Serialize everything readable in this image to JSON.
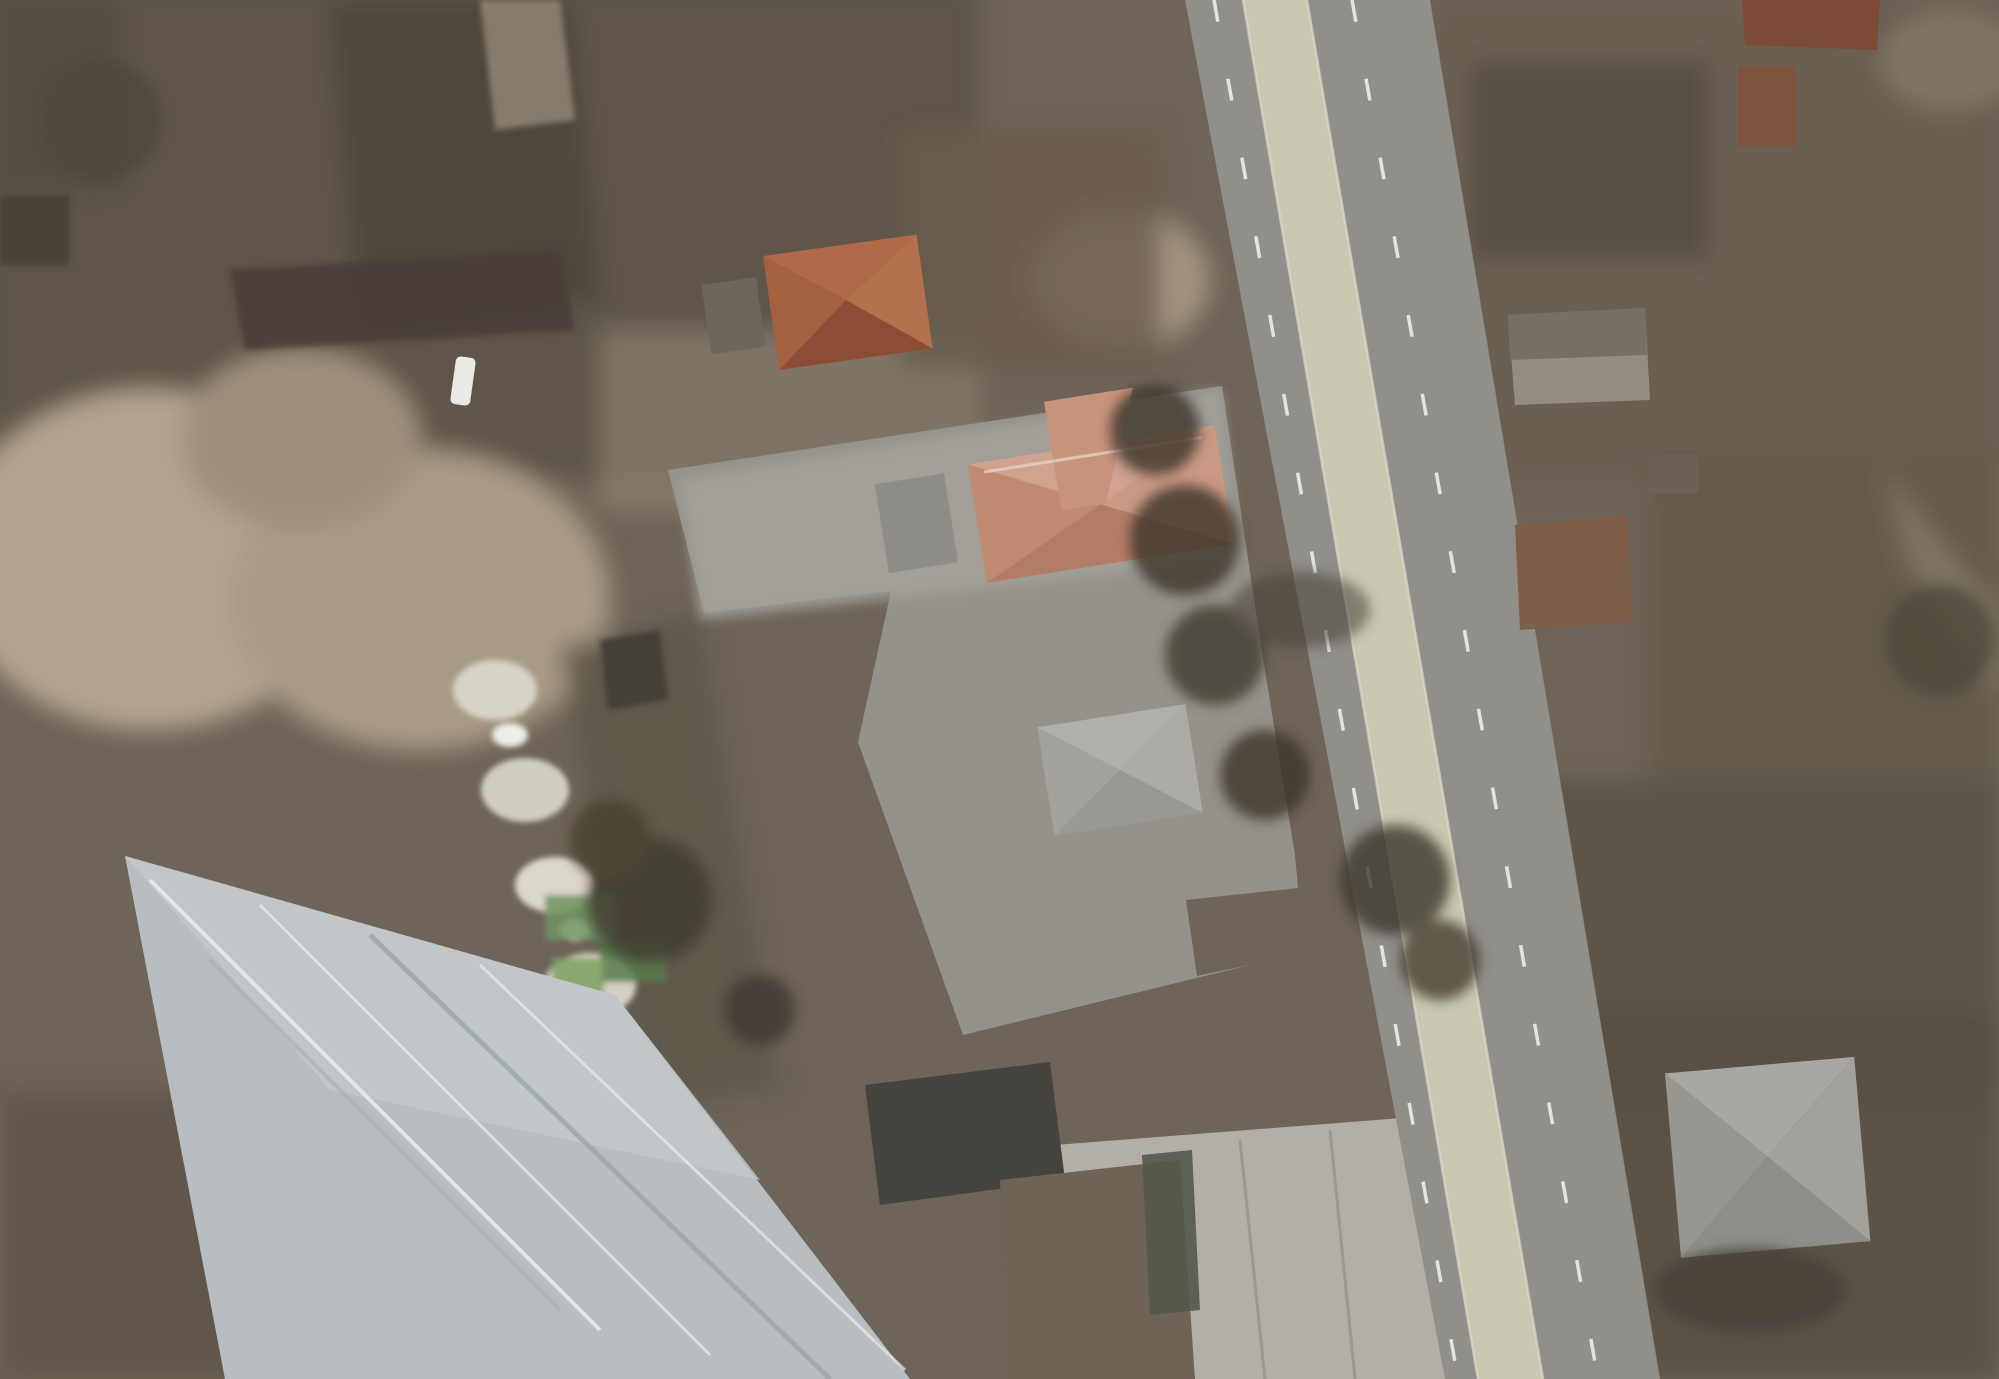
{
  "map": {
    "street_label": {
      "text": "str. Mihai Eminescu",
      "x": 1372,
      "y": 705,
      "rotation": 81,
      "size": 38
    },
    "survey_label": {
      "text": "6453210",
      "x": 883,
      "y": 692,
      "size": 30
    },
    "parcel_labels": [
      {
        "text": "161",
        "x": 158,
        "y": 139,
        "s": 46
      },
      {
        "text": "162",
        "x": 446,
        "y": 115,
        "s": 46
      },
      {
        "text": "216",
        "x": 684,
        "y": 30,
        "s": 40
      },
      {
        "text": "206",
        "x": 704,
        "y": 86,
        "s": 40
      },
      {
        "text": "1",
        "x": 733,
        "y": 125,
        "s": 30
      },
      {
        "text": "1",
        "x": 744,
        "y": 172,
        "s": 30
      },
      {
        "text": "203",
        "x": 742,
        "y": 205,
        "s": 40
      },
      {
        "text": "220",
        "x": 1006,
        "y": 254,
        "s": 44
      },
      {
        "text": "165",
        "x": 846,
        "y": 352,
        "s": 44
      },
      {
        "text": "8",
        "x": 157,
        "y": 318,
        "s": 38
      },
      {
        "text": "9",
        "x": 108,
        "y": 369,
        "s": 38
      },
      {
        "text": "59",
        "x": 20,
        "y": 537,
        "s": 46
      },
      {
        "text": "166",
        "x": 1042,
        "y": 667,
        "s": 48
      },
      {
        "text": "130",
        "x": 1550,
        "y": 92,
        "s": 44
      },
      {
        "text": "129",
        "x": 1855,
        "y": 100,
        "s": 44
      },
      {
        "text": "1",
        "x": 1772,
        "y": 12,
        "s": 30
      },
      {
        "text": "1",
        "x": 1541,
        "y": 375,
        "s": 30
      },
      {
        "text": "131",
        "x": 1690,
        "y": 435,
        "s": 44
      },
      {
        "text": "1",
        "x": 1543,
        "y": 589,
        "s": 28
      },
      {
        "text": "132",
        "x": 1707,
        "y": 650,
        "s": 44
      },
      {
        "text": "7",
        "x": 1402,
        "y": 748,
        "s": 34
      },
      {
        "text": "239",
        "x": 1729,
        "y": 965,
        "s": 44
      },
      {
        "text": "8",
        "x": 88,
        "y": 1052,
        "s": 36
      },
      {
        "text": "242",
        "x": 387,
        "y": 1072,
        "s": 44
      },
      {
        "text": "7",
        "x": 408,
        "y": 1165,
        "s": 36
      },
      {
        "text": "6",
        "x": 780,
        "y": 872,
        "s": 36
      },
      {
        "text": "3",
        "x": 880,
        "y": 1152,
        "s": 36
      },
      {
        "text": "244",
        "x": 1127,
        "y": 1232,
        "s": 44
      },
      {
        "text": "1",
        "x": 1053,
        "y": 1315,
        "s": 30
      },
      {
        "text": "1",
        "x": 1705,
        "y": 1157,
        "s": 32
      },
      {
        "text": "133",
        "x": 1763,
        "y": 1154,
        "s": 44
      },
      {
        "text": "2",
        "x": 1798,
        "y": 1176,
        "s": 32
      },
      {
        "text": "785",
        "x": 22,
        "y": 1372,
        "s": 36
      }
    ],
    "address_labels": [
      {
        "text": "15/B",
        "x": 1098,
        "y": 641,
        "s": 36
      },
      {
        "text": "10",
        "x": 1505,
        "y": 322,
        "s": 38
      },
      {
        "text": "8",
        "x": 1555,
        "y": 549,
        "s": 36
      },
      {
        "text": "6",
        "x": 1716,
        "y": 1119,
        "s": 40
      },
      {
        "text": "15/A",
        "x": 1049,
        "y": 1345,
        "s": 38
      }
    ],
    "dots": [
      [
        1152,
        662
      ],
      [
        1535,
        349
      ],
      [
        1576,
        573
      ],
      [
        1735,
        1143
      ],
      [
        1093,
        1368
      ]
    ],
    "dot_radius": 13,
    "hexagon": {
      "x": 1224,
      "y": 931,
      "r": 17
    },
    "arrow_points": "492,779 718,797 716,770 799,822 719,868 721,842 494,831",
    "cursor_points": "17,758 38,746 31,757 40,769 17,758",
    "colors": {
      "yellow": "#e8ea06",
      "green": "#31e23e",
      "teal": "#1cc474",
      "outline_green": "#1dc878",
      "red": "#d8301c",
      "red_fill": "rgba(205,35,20,0.38)",
      "red_fill_light": "rgba(205,35,20,0.12)",
      "orange": "#eda611",
      "dot": "#ffe61a",
      "dot_edge": "#20200e",
      "arrow": "#f6ee39"
    },
    "lines": {
      "yellow": [
        "315,0 323,60 343,203 325,227 330,250 305,262 306,343 317,460 340,600 352,690",
        "0,352 290,322 308,305 572,260 600,256",
        "28,450 48,350 95,290 150,270",
        "0,385 210,362 305,345",
        "0,412 190,388 252,378",
        "0,4 118,1",
        "545,0 568,160 595,352",
        "538,45 785,15 1000,0",
        "548,95 920,53 1143,8",
        "558,133 950,78 1148,42",
        "566,172 965,117 1150,80",
        "574,210 900,130",
        "900,130 1153,143",
        "620,300 900,315 1190,358",
        "595,352 640,385 668,470",
        "1133,0 1202,360 1228,390",
        "1300,885 1328,1043 1372,1220 1420,1379",
        "1375,0 1404,258 1450,542 1490,767 1563,1050 1627,1377",
        "1406,260 1983,339",
        "1705,0 1700,212 1697,300",
        "1457,450 1945,488",
        "1513,835 1922,805",
        "1999,295 1983,339 1951,462 1937,652 1918,803 1917,1003 1953,1290 1962,1379",
        "1545,1028 1917,1003",
        "1953,1290 1620,1327",
        "1620,1330 1850,1379",
        "937,1030 958,1037 963,1060 842,1077 830,1097 858,1212 888,1360 895,1379",
        "0,848 280,790 520,740 558,735",
        "0,750 350,690 558,645",
        "1310,947 1230,950 1190,1045",
        "648,1115 672,1250 690,1379",
        "780,1090 830,1097"
      ],
      "green_main": [
        "668,470 1222,386 1262,652 1295,855 1298,888 1186,900 1197,976 1254,964 963,1035 858,742 891,591 704,613 668,470"
      ],
      "teal_parcel": [
        "560,648 700,612 780,1088 645,1112 560,648"
      ],
      "outlines": [
        "150,268 268,264 272,316 154,320 150,268",
        "222,268 227,318",
        "154,320 233,316 238,348 95,354 154,320",
        "2,3 16,5 19,33 3,36 2,3",
        "932,0 1085,0 1083,38 933,42 932,0",
        "1742,0 1880,0 1877,20 1838,21 1840,48 1742,42 1742,0",
        "1735,65 1797,62 1800,118 1738,121 1735,65",
        "1757,120 1797,118 1799,147 1759,149 1757,120",
        "1505,312 1578,305 1580,318 1648,312 1652,398 1512,405 1505,312",
        "1652,318 1672,317 1674,398 1654,399 1652,318",
        "1511,527 1605,517 1608,545 1630,543 1633,620 1545,629 1543,601 1515,603 1511,527",
        "1646,454 1699,450 1702,492 1649,496 1646,454",
        "1663,1057 1813,1040 1818,1143 1866,1141 1870,1248 1678,1263 1663,1057",
        "1780,1147 1785,1248",
        "820,1072 935,1032 977,1180 1140,1152 1160,1245 1197,1308 1193,1379",
        "977,1180 997,1379",
        "125,855 133,930 167,1093 200,1250 233,1379",
        "82,930 35,995 60,1120 165,1113 158,1035 82,930"
      ],
      "red": [
        "711,60 747,274",
        "790,38 826,248",
        "846,1085 975,1070 985,1192 856,1206 846,1085"
      ],
      "red_fills": [
        "472,215 628,196 636,232 480,250",
        "800,130 870,115 882,175 812,190"
      ],
      "red_fills_light": [
        "846,1085 975,1070 985,1192 856,1206"
      ],
      "orange_segments": [
        "472,213 630,194"
      ]
    }
  }
}
